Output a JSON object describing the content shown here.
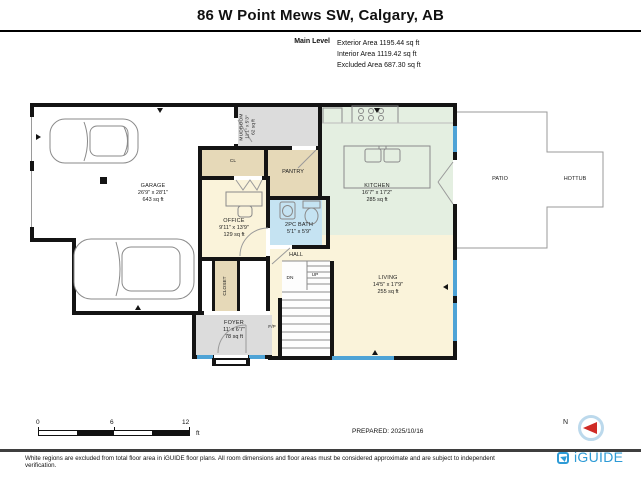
{
  "header": {
    "title": "86 W Point Mews SW, Calgary, AB",
    "level_label": "Main Level",
    "areas": [
      "Exterior Area 1195.44 sq ft",
      "Interior Area 1119.42 sq ft",
      "Excluded Area 687.30 sq ft"
    ]
  },
  "rooms": {
    "garage": {
      "name": "GARAGE",
      "dims": "26'9\" x 28'1\"",
      "area": "643 sq ft"
    },
    "mudroom": {
      "name": "MUDROOM",
      "dims": "11'1\" x 5'3\"",
      "area": "62 sq ft"
    },
    "cl": {
      "name": "CL"
    },
    "pantry": {
      "name": "PANTRY"
    },
    "office": {
      "name": "OFFICE",
      "dims": "9'11\" x 13'9\"",
      "area": "129 sq ft"
    },
    "bath": {
      "name": "2PC BATH",
      "dims": "5'1\" x 5'9\""
    },
    "kitchen": {
      "name": "KITCHEN",
      "dims": "16'7\" x 17'2\"",
      "area": "285 sq ft"
    },
    "living": {
      "name": "LIVING",
      "dims": "14'5\" x 17'9\"",
      "area": "255 sq ft"
    },
    "hall": {
      "name": "HALL"
    },
    "closet": {
      "name": "CLOSET"
    },
    "foyer": {
      "name": "FOYER",
      "dims": "11' x 6'7\"",
      "area": "78 sq ft"
    },
    "patio": {
      "name": "PATIO"
    },
    "hottub": {
      "name": "HOTTUB"
    },
    "stairs": {
      "dn": "DN",
      "up": "UP"
    },
    "fireplace": {
      "label": "F/P"
    }
  },
  "scale_bar": {
    "ticks": [
      "0",
      "6",
      "12"
    ],
    "unit": "ft"
  },
  "compass": {
    "label": "N"
  },
  "footer": {
    "prepared": "PREPARED: 2025/10/16",
    "disclaimer": "White regions are excluded from total floor area in iGUIDE floor plans. All room dimensions and floor areas must be considered approximate and are subject to independent verification.",
    "brand": "iGUIDE"
  },
  "colors": {
    "wall": "#141414",
    "window": "#4ea3d6",
    "room_cream": "#faf3da",
    "room_gray": "#dcdcdc",
    "room_tan": "#e6d9b8",
    "room_green": "#e4efe1",
    "room_blue": "#c5e3f2",
    "brand_blue": "#2e9bd6",
    "compass_red": "#cf2b26"
  }
}
